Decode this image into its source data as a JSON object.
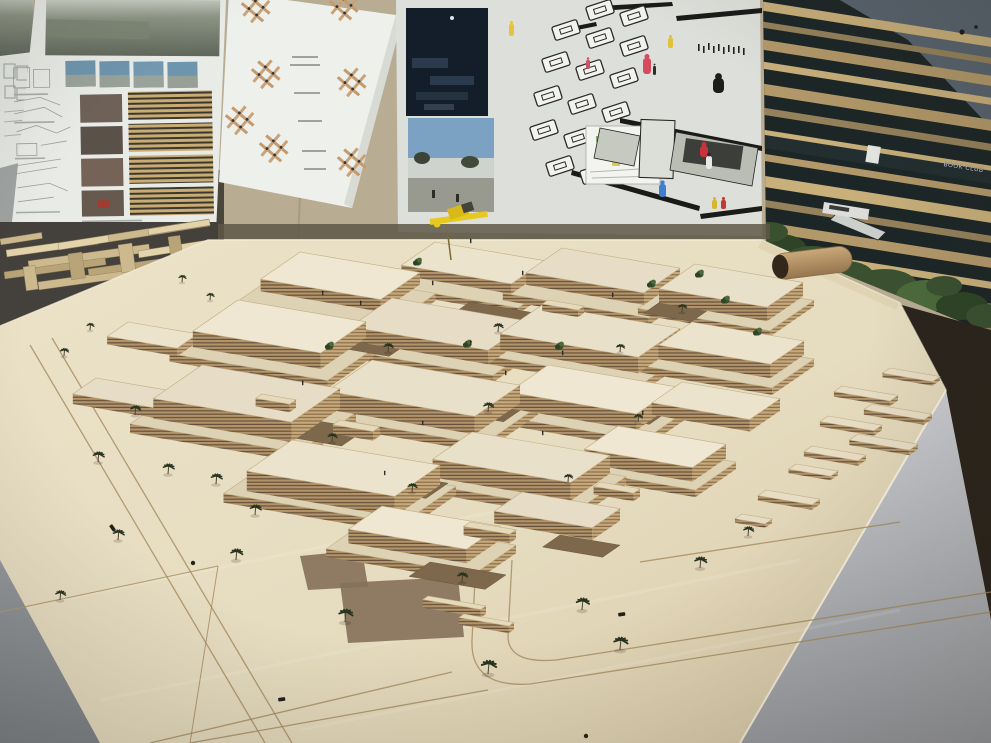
{
  "labels": {
    "right_poster_sign": "BOOK CLUB"
  },
  "colors": {
    "wall": "#b8ad93",
    "wall_gray": "#9fa3a1",
    "slot_dark": "#4b463c",
    "under_shadow": "#5e5747",
    "paper_white": "#e9ebe7",
    "paper_gray": "#dde0da",
    "sheet": "#eef0ec",
    "board_dark": "#1d2627",
    "sky": "#59646e",
    "slat_shades": [
      "#c9b07b",
      "#b3996a",
      "#95825c"
    ],
    "table": "#e8dec3",
    "table_dark": "#d6c7a5",
    "roofs": [
      "#ece3cd",
      "#e7ddc6",
      "#efe7d2",
      "#e9e0ca"
    ],
    "plinth_roof": "#ddd2b4",
    "dirt": "#7e684c",
    "dirt2": "#85705a",
    "palm": "#273420",
    "trunk": "#53422c",
    "bush": [
      "#3a5130",
      "#4c6a3b",
      "#2f4427"
    ],
    "floor_left": "#8e9297",
    "pedestal_hi": "#cbccd0",
    "pedestal_lo": "#9b9da2",
    "floor_dark": "#2b241c",
    "road": "#a28a5c",
    "seam": "#b29a70",
    "crane_yellow": "#e6c81f",
    "crane_dark": "#44423a",
    "speck": "#1a1f24",
    "figure_dark": "#33302a"
  },
  "scene": {
    "buildings": [
      [
        300,
        252,
        120,
        68,
        12
      ],
      [
        435,
        242,
        110,
        58,
        10
      ],
      [
        562,
        248,
        118,
        62,
        12
      ],
      [
        695,
        264,
        108,
        62,
        14
      ],
      [
        238,
        300,
        128,
        78,
        16
      ],
      [
        392,
        298,
        138,
        72,
        14
      ],
      [
        542,
        305,
        138,
        72,
        16
      ],
      [
        692,
        322,
        112,
        58,
        14
      ],
      [
        202,
        365,
        138,
        84,
        20
      ],
      [
        372,
        360,
        148,
        78,
        18
      ],
      [
        548,
        365,
        128,
        68,
        16
      ],
      [
        682,
        382,
        98,
        52,
        12
      ],
      [
        292,
        440,
        148,
        78,
        20
      ],
      [
        472,
        432,
        138,
        68,
        18
      ],
      [
        618,
        426,
        108,
        58,
        14
      ],
      [
        382,
        506,
        118,
        58,
        14
      ],
      [
        522,
        492,
        98,
        48,
        12
      ],
      [
        128,
        322,
        70,
        36,
        8
      ],
      [
        96,
        378,
        84,
        40,
        10
      ]
    ],
    "plinths": [
      [
        286,
        268,
        150,
        84,
        7
      ],
      [
        424,
        256,
        136,
        72,
        6
      ],
      [
        548,
        262,
        146,
        78,
        7
      ],
      [
        682,
        278,
        132,
        76,
        6
      ],
      [
        224,
        316,
        158,
        94,
        8
      ],
      [
        378,
        312,
        166,
        88,
        7
      ],
      [
        528,
        320,
        166,
        86,
        8
      ],
      [
        678,
        336,
        136,
        72,
        7
      ],
      [
        188,
        384,
        168,
        100,
        9
      ],
      [
        358,
        376,
        180,
        94,
        8
      ],
      [
        534,
        380,
        158,
        84,
        8
      ],
      [
        278,
        456,
        178,
        94,
        9
      ],
      [
        458,
        448,
        168,
        84,
        8
      ],
      [
        606,
        440,
        130,
        70,
        7
      ],
      [
        368,
        520,
        148,
        72,
        8
      ]
    ],
    "courtyards": [
      [
        352,
        332,
        58,
        36
      ],
      [
        470,
        302,
        66,
        38
      ],
      [
        592,
        332,
        56,
        32
      ],
      [
        300,
        418,
        66,
        42
      ],
      [
        452,
        392,
        76,
        42
      ],
      [
        612,
        402,
        56,
        32
      ],
      [
        382,
        472,
        66,
        38
      ],
      [
        542,
        462,
        56,
        32
      ],
      [
        660,
        302,
        48,
        28
      ],
      [
        430,
        562,
        76,
        36
      ],
      [
        560,
        535,
        60,
        30
      ],
      [
        250,
        372,
        44,
        28
      ]
    ],
    "stairs": [
      [
        340,
        420,
        40,
        12,
        9
      ],
      [
        470,
        522,
        46,
        11,
        9
      ],
      [
        600,
        482,
        40,
        11,
        8
      ],
      [
        262,
        394,
        34,
        11,
        8
      ],
      [
        428,
        596,
        58,
        9,
        8
      ],
      [
        464,
        614,
        50,
        9,
        7
      ],
      [
        548,
        300,
        36,
        10,
        7
      ]
    ],
    "plots": [
      [
        890,
        368,
        50,
        13,
        4
      ],
      [
        842,
        386,
        56,
        14,
        5
      ],
      [
        872,
        404,
        60,
        14,
        5
      ],
      [
        828,
        416,
        54,
        14,
        5
      ],
      [
        858,
        434,
        60,
        15,
        5
      ],
      [
        812,
        446,
        54,
        14,
        5
      ],
      [
        796,
        464,
        42,
        13,
        4
      ],
      [
        766,
        490,
        54,
        14,
        5
      ],
      [
        742,
        514,
        30,
        12,
        4
      ]
    ],
    "palms": [
      [
        135,
        415,
        1.1
      ],
      [
        98,
        462,
        1.2
      ],
      [
        168,
        474,
        1.2
      ],
      [
        216,
        484,
        1.2
      ],
      [
        64,
        356,
        0.9
      ],
      [
        255,
        515,
        1.2
      ],
      [
        345,
        622,
        1.5
      ],
      [
        488,
        674,
        1.6
      ],
      [
        582,
        610,
        1.4
      ],
      [
        620,
        650,
        1.5
      ],
      [
        700,
        568,
        1.3
      ],
      [
        748,
        536,
        1.1
      ],
      [
        236,
        560,
        1.3
      ],
      [
        118,
        540,
        1.2
      ],
      [
        60,
        600,
        1.1
      ],
      [
        210,
        300,
        0.8
      ],
      [
        182,
        282,
        0.8
      ],
      [
        90,
        330,
        0.8
      ],
      [
        388,
        352,
        1.0
      ],
      [
        498,
        332,
        1.0
      ],
      [
        620,
        352,
        0.9
      ],
      [
        332,
        442,
        1.0
      ],
      [
        488,
        412,
        1.1
      ],
      [
        638,
        422,
        0.9
      ],
      [
        412,
        492,
        1.0
      ],
      [
        568,
        482,
        0.9
      ],
      [
        462,
        582,
        1.1
      ],
      [
        682,
        312,
        0.9
      ]
    ],
    "bushes": [
      [
        700,
        274
      ],
      [
        726,
        300
      ],
      [
        758,
        332
      ],
      [
        652,
        284
      ],
      [
        560,
        346
      ],
      [
        468,
        344
      ],
      [
        418,
        262
      ],
      [
        330,
        346
      ]
    ],
    "roof_people": [
      [
        322,
        292
      ],
      [
        360,
        302
      ],
      [
        432,
        282
      ],
      [
        522,
        272
      ],
      [
        612,
        294
      ],
      [
        470,
        342
      ],
      [
        562,
        352
      ],
      [
        302,
        382
      ],
      [
        422,
        422
      ],
      [
        542,
        432
      ],
      [
        642,
        412
      ],
      [
        384,
        472
      ],
      [
        505,
        372
      ],
      [
        470,
        240
      ]
    ],
    "cars": [
      [
        278,
        698,
        -8
      ],
      [
        618,
        613,
        -8
      ],
      [
        112,
        524,
        55
      ]
    ],
    "pins": [
      [
        193,
        563
      ],
      [
        586,
        736
      ]
    ],
    "small_model_bars": [
      [
        6,
        250,
        92,
        7,
        -8,
        0
      ],
      [
        28,
        261,
        122,
        8,
        -8,
        1
      ],
      [
        4,
        272,
        102,
        7,
        -8,
        2
      ],
      [
        58,
        243,
        112,
        7,
        -9,
        0
      ],
      [
        108,
        235,
        102,
        7,
        -9,
        1
      ],
      [
        148,
        229,
        62,
        6,
        -9,
        0
      ],
      [
        38,
        282,
        132,
        8,
        -8,
        1
      ],
      [
        88,
        269,
        112,
        7,
        -8,
        2
      ],
      [
        138,
        251,
        72,
        7,
        -9,
        0
      ],
      [
        68,
        254,
        14,
        26,
        -8,
        2
      ],
      [
        118,
        245,
        14,
        28,
        -8,
        1
      ],
      [
        168,
        237,
        12,
        24,
        -8,
        2
      ],
      [
        23,
        267,
        12,
        24,
        -8,
        1
      ],
      [
        183,
        251,
        42,
        6,
        -9,
        0
      ],
      [
        0,
        239,
        42,
        6,
        -9,
        1
      ],
      [
        96,
        287,
        90,
        7,
        -8,
        0
      ]
    ],
    "board_figures": [
      [
        509,
        24,
        5,
        12,
        "#e7c337"
      ],
      [
        643,
        58,
        8,
        16,
        "#d84b5e"
      ],
      [
        653,
        66,
        3,
        9,
        "#2e2d2b"
      ],
      [
        668,
        38,
        5,
        10,
        "#e0c23a"
      ],
      [
        713,
        78,
        11,
        15,
        "#1d1d1b"
      ],
      [
        700,
        146,
        8,
        11,
        "#c8333d"
      ],
      [
        706,
        156,
        6,
        13,
        "#e8e8e4"
      ],
      [
        659,
        184,
        7,
        13,
        "#3f7fd0"
      ],
      [
        712,
        200,
        5,
        9,
        "#d8b62e"
      ],
      [
        721,
        200,
        5,
        9,
        "#c23a33"
      ],
      [
        586,
        60,
        4,
        9,
        "#c95360"
      ]
    ],
    "crowd": [
      [
        698,
        44
      ],
      [
        703,
        46
      ],
      [
        708,
        43
      ],
      [
        713,
        46
      ],
      [
        718,
        44
      ],
      [
        723,
        47
      ],
      [
        728,
        45
      ],
      [
        733,
        47
      ],
      [
        738,
        46
      ],
      [
        743,
        48
      ]
    ],
    "rings": [
      [
        600,
        10
      ],
      [
        634,
        16
      ],
      [
        566,
        30
      ],
      [
        600,
        38
      ],
      [
        634,
        46
      ],
      [
        556,
        62
      ],
      [
        590,
        70
      ],
      [
        624,
        78
      ],
      [
        548,
        96
      ],
      [
        582,
        104
      ],
      [
        616,
        112
      ],
      [
        544,
        130
      ],
      [
        578,
        138
      ],
      [
        612,
        146
      ],
      [
        560,
        166
      ],
      [
        594,
        174
      ]
    ],
    "hashes": [
      [
        256,
        8
      ],
      [
        344,
        6
      ],
      [
        266,
        74
      ],
      [
        352,
        82
      ],
      [
        274,
        148
      ],
      [
        352,
        162
      ],
      [
        240,
        120
      ]
    ],
    "slats": [
      [
        -2,
        9,
        0
      ],
      [
        18,
        6,
        2
      ],
      [
        36,
        10,
        1
      ],
      [
        58,
        7,
        0
      ],
      [
        80,
        11,
        1
      ],
      [
        104,
        7,
        2
      ],
      [
        126,
        10,
        0
      ],
      [
        150,
        7,
        1
      ],
      [
        172,
        11,
        0
      ],
      [
        196,
        7,
        2
      ],
      [
        218,
        10,
        1
      ],
      [
        242,
        7,
        0
      ],
      [
        264,
        11,
        1
      ],
      [
        288,
        7,
        2
      ],
      [
        310,
        10,
        0
      ]
    ],
    "greenery": [
      [
        780,
        248,
        26,
        14
      ],
      [
        812,
        262,
        30,
        16
      ],
      [
        846,
        276,
        28,
        15
      ],
      [
        884,
        286,
        34,
        17
      ],
      [
        926,
        296,
        30,
        16
      ],
      [
        962,
        306,
        26,
        14
      ],
      [
        986,
        316,
        20,
        12
      ],
      [
        800,
        300,
        24,
        13
      ],
      [
        860,
        312,
        26,
        14
      ],
      [
        910,
        326,
        24,
        13
      ],
      [
        944,
        286,
        18,
        10
      ],
      [
        770,
        232,
        18,
        10
      ]
    ],
    "roads": [
      "M 30 345 L 265 743",
      "M 52 338 L 292 743",
      "M 476 560 L 472 640 Q 470 688 530 684 L 991 612",
      "M 512 560 L 508 636 Q 508 664 556 660 L 991 592",
      "M 150 743 L 452 672",
      "M 190 743 L 488 690",
      "M 640 562 L 900 522"
    ],
    "seams": [
      "M 0 612 L 218 566",
      "M 218 566 L 190 743"
    ],
    "dirt_patches": [
      [
        340,
        583,
        118,
        60
      ],
      [
        300,
        556,
        62,
        34
      ]
    ],
    "specks": [
      [
        962,
        32,
        2.6
      ],
      [
        976,
        27,
        1.8
      ]
    ]
  }
}
